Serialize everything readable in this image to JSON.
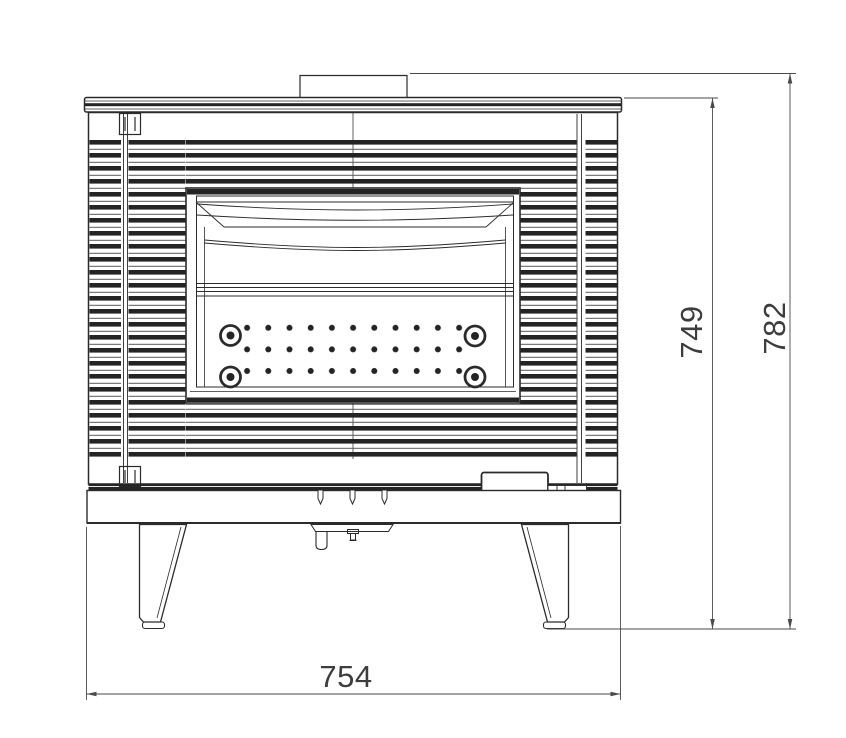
{
  "drawing": {
    "kind": "technical-elevation",
    "dimensions": {
      "height_body": "749",
      "height_overall": "782",
      "width_base": "754"
    },
    "colors": {
      "line": "#2b2b2b",
      "dimension_line": "#4a4a4a",
      "dimension_text": "#3d3d3d",
      "background": "#ffffff"
    }
  }
}
